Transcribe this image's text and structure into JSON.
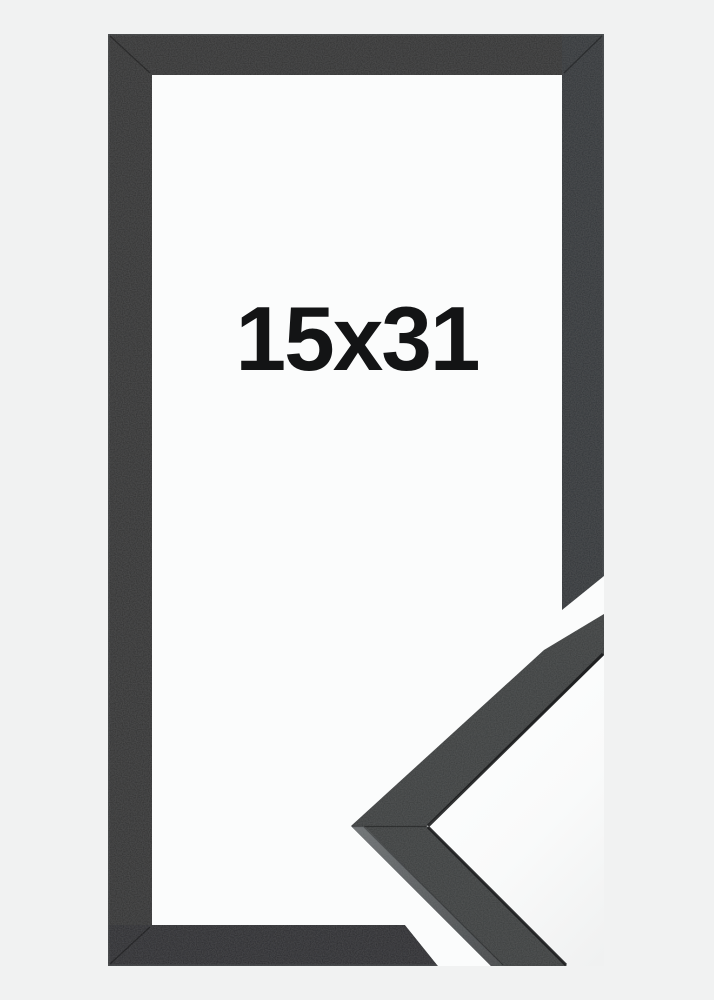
{
  "product": {
    "size_label": "15x31"
  },
  "colors": {
    "background": "#f1f2f2",
    "photo_white": "#fbfcfc",
    "frame_face": "#303233",
    "frame_face_right": "#333537",
    "frame_face_bottom": "#2a2c2d",
    "detail_face": "#3a3c3d",
    "detail_edge_highlight_top": "#6d7173",
    "detail_edge_highlight_bottom": "#45484a",
    "label_text": "#131415"
  }
}
